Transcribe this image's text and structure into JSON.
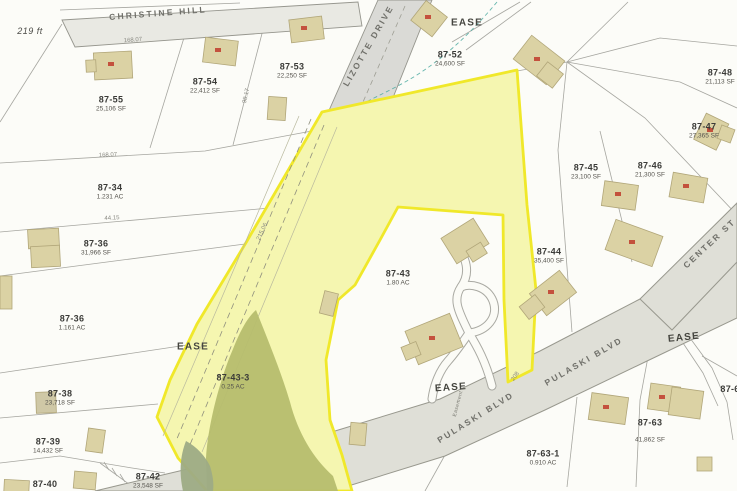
{
  "map": {
    "scale_label": "219 ft",
    "streets": {
      "christine": "CHRISTINE HILL",
      "lizotte": "LIZOTTE DRIVE",
      "pulaski_1": "PULASKI BLVD",
      "pulaski_2": "PULASKI BLVD",
      "center": "CENTER ST"
    },
    "easements": {
      "top": "EASE",
      "left": "EASE",
      "mid": "EASE",
      "right": "EASE",
      "small": "Easement"
    },
    "highlight": {
      "parcel_ids": [
        "87-43",
        "87-43-3"
      ],
      "color": "#f0e82a"
    },
    "parcels": [
      {
        "id": "87-55",
        "area": "25,106 SF"
      },
      {
        "id": "87-54",
        "area": "22,412 SF"
      },
      {
        "id": "87-53",
        "area": "22,250 SF"
      },
      {
        "id": "87-52",
        "area": "24,600 SF"
      },
      {
        "id": "87-48",
        "area": "21,113 SF"
      },
      {
        "id": "87-47",
        "area": "27,365 SF"
      },
      {
        "id": "87-45",
        "area": "23,100 SF"
      },
      {
        "id": "87-46",
        "area": "21,300 SF"
      },
      {
        "id": "87-44",
        "area": "35,400 SF"
      },
      {
        "id": "87-43",
        "area": "1.80 AC"
      },
      {
        "id": "87-43-3",
        "area": "0.25 AC"
      },
      {
        "id": "87-34",
        "area": "1.231 AC"
      },
      {
        "id": "87-36",
        "area": "31,966 SF"
      },
      {
        "id": "87-36",
        "area": "1.161 AC"
      },
      {
        "id": "87-38",
        "area": "23,718 SF"
      },
      {
        "id": "87-39",
        "area": "14,432 SF"
      },
      {
        "id": "87-40",
        "area": ""
      },
      {
        "id": "87-42",
        "area": "23,548 SF"
      },
      {
        "id": "87-63",
        "area": "41,862 SF"
      },
      {
        "id": "87-63-1",
        "area": "0.910 AC"
      },
      {
        "id": "87-6",
        "area": ""
      }
    ],
    "dims": [
      "168.07",
      "168.07",
      "98.17",
      "44.15",
      "215.06",
      "208"
    ]
  }
}
